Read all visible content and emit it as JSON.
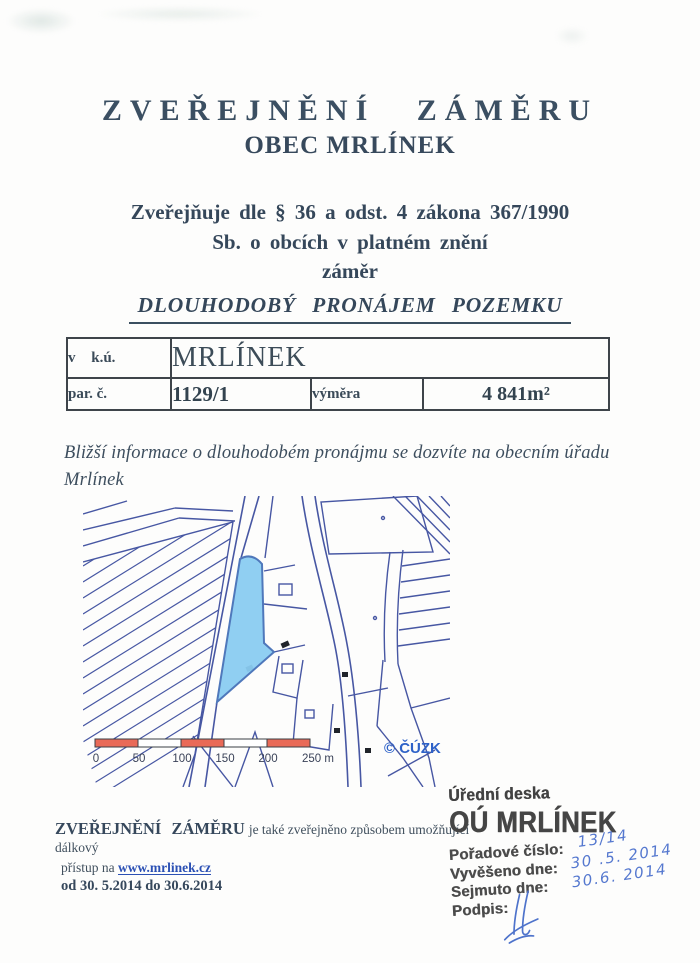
{
  "document": {
    "title_line1": "ZVEŘEJNĚNÍ ZÁMĚRU",
    "title_line2": "OBEC MRLÍNEK",
    "subtitle_line1": "Zveřejňuje dle § 36 a odst. 4 zákona 367/1990",
    "subtitle_line2": "Sb. o obcích v platném znění",
    "subtitle_line3": "záměr",
    "heading_underlined": "DLOUHODOBÝ PRONÁJEM POZEMKU",
    "table": {
      "row1_label": "v k.ú.",
      "row1_value": "MRLÍNEK",
      "row2_label": "par. č.",
      "row2_value": "1129/1",
      "row2_label2": "výměra",
      "row2_value2": "4 841m²"
    },
    "info_paragraph": "Bližší informace o dlouhodobém pronájmu se dozvíte na obecním úřadu  Mrlínek",
    "map": {
      "scale_labels": [
        "0",
        "50",
        "100",
        "150",
        "200",
        "250 m"
      ],
      "copyright": "© ČÚZK",
      "line_color": "#4757a3",
      "parcel_fill": "#8accf1",
      "parcel_stroke": "#4f78bb",
      "scale_red": "#e96a57"
    },
    "footer": {
      "bold_intro": "ZVEŘEJNĚNÍ  ZÁMĚRU",
      "rest_line1": "je také  zveřejněno způsobem umožňující dálkový",
      "line2_prefix": "přístup na",
      "link": "www.mrlinek.cz",
      "line3": "od 30. 5.2014 do 30.6.2014"
    },
    "stamp": {
      "line1": "Úřední deska",
      "line2": "OÚ MRLÍNEK",
      "rows": [
        {
          "label": "Pořadové číslo:",
          "value": "13/14"
        },
        {
          "label": "Vyvěšeno  dne:",
          "value": "30 .5. 2014"
        },
        {
          "label": "Sejmuto  dne:",
          "value": "30.6. 2014"
        },
        {
          "label": "Podpis:",
          "value": ""
        }
      ]
    }
  }
}
